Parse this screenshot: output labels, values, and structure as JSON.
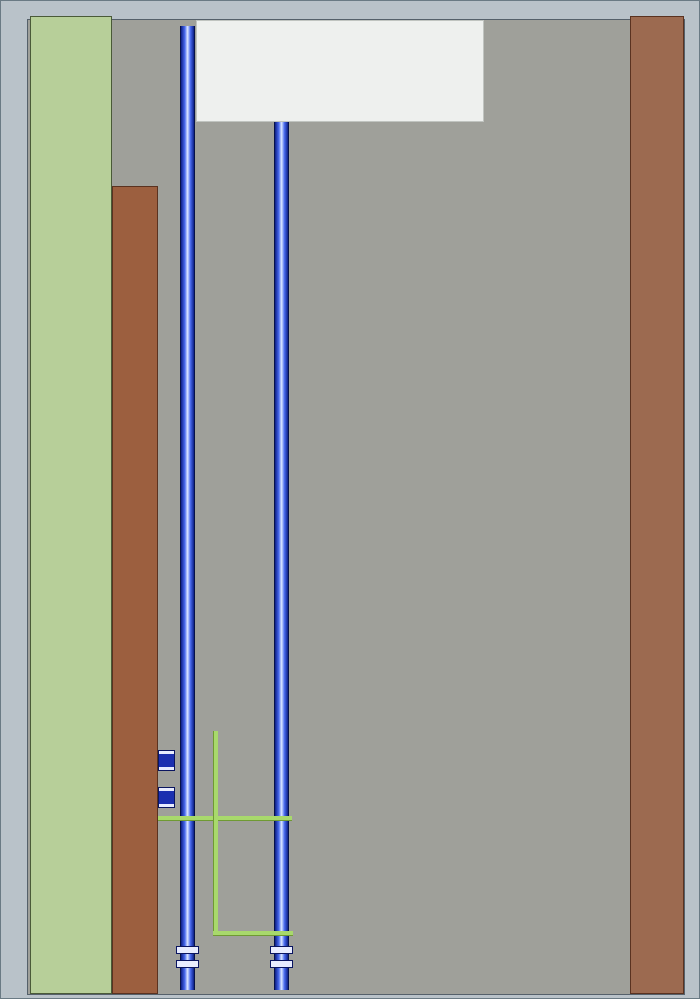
{
  "title": "XX井下中央泵房自动化排水系统主画面",
  "menu": {
    "items": [
      "1#单台画面",
      "2#单台画面",
      "3#单台画面",
      "数据设定画面",
      "生产统计画面",
      "系统报警画面",
      "系统退出键"
    ]
  },
  "mode_panel": {
    "buttons": [
      {
        "label": "控柜模式",
        "state": "active"
      },
      {
        "label": "集控模式",
        "state": "inactive"
      },
      {
        "label": "遥控模式",
        "state": "inactive"
      },
      {
        "label": "紧启模式",
        "state": "inactive"
      },
      {
        "label": "控箱模式",
        "state": "active"
      },
      {
        "label": "1#就地",
        "state": "inactive"
      },
      {
        "label": "2#就地",
        "state": "inactive"
      },
      {
        "label": "3#就地",
        "state": "inactive"
      },
      {
        "label": "参数设置",
        "state": "active"
      },
      {
        "label": "WINCC_SET",
        "state": "inactive"
      },
      {
        "label": "TOUCH_SET",
        "state": "inactive"
      },
      {
        "label": "T触摸屏",
        "state": "active"
      },
      {
        "label": "T自动翻屏",
        "state": "inactive"
      },
      {
        "label": "T手动翻屏",
        "state": "inactive"
      }
    ]
  },
  "footer": {
    "date": "2014-5-11",
    "time": "16:45:39",
    "company": "江苏金宏泰科技股份有限公司"
  },
  "level_buttons": [
    "四米位",
    "三米位",
    "二米位",
    "一米位",
    "0米位"
  ],
  "sump_scale": [
    "+8.00",
    "+7.00",
    "+6.00",
    "+5.00",
    "+4.00",
    "+3.00",
    "+2.00",
    "+1.00",
    "+0.00"
  ],
  "groups": [
    {
      "id": "3#",
      "valve_tag_pairs": [
        [
          "3#闸阀V1",
          "3#排水V1"
        ],
        [
          "3#闸阀V2",
          "3#排水V2"
        ],
        [
          "3#闸阀V3",
          "3#排水V3"
        ]
      ],
      "gauges": [
        {
          "label": "高压表",
          "value": "99.9MPa"
        },
        {
          "label": "真空表",
          "value": "99.9KPa"
        },
        {
          "label": "低压表",
          "value": "99.9MPa"
        }
      ],
      "motor": {
        "current_label": "电流",
        "current_value": "99.9A",
        "temp_label": "温度",
        "temp_value": "99.9℃"
      },
      "pump": {
        "temp_label": "温度",
        "temp_value": "99.9℃"
      },
      "station": {
        "title": "3#液压站",
        "tags": [
          "3#管阀开",
          "3#管阀开",
          "3#管阀开"
        ]
      },
      "display": {
        "label_top": "水仓",
        "label_bottom": "水位",
        "value": "99.99",
        "unit": "米"
      }
    },
    {
      "id": "2#",
      "valve_tag_pairs": [
        [
          "2#闸阀V1",
          "2#排水V1"
        ],
        [
          "2#闸阀V2",
          "2#排水V2"
        ],
        [
          "2#闸阀V3",
          "2#排水V3"
        ]
      ],
      "gauges": [
        {
          "label": "高压表",
          "value": "99.9MPa"
        },
        {
          "label": "真空表",
          "value": "99.9KPa"
        },
        {
          "label": "低压表",
          "value": "99.9MPa"
        }
      ],
      "motor": {
        "current_label": "电流",
        "current_value": "99.9A",
        "temp_label": "温度",
        "temp_value": "99.9℃"
      },
      "pump": {
        "temp_label": "温度",
        "temp_value": "99.9℃"
      },
      "station": {
        "title": "2#液压站",
        "tags": [
          "2#管阀开",
          "2#管阀开",
          "2#管阀开"
        ]
      },
      "display": {
        "label_top": "水仓",
        "label_bottom": "水位",
        "value": "99.99",
        "unit": "米"
      }
    },
    {
      "id": "1#",
      "valve_tag_pairs": [
        [
          "1#闸阀V1",
          "1#排水V1"
        ],
        [
          "1#闸阀V2",
          "1#排水V2"
        ],
        [
          "1#闸阀V3",
          "1#排水V3"
        ]
      ],
      "gauges": [
        {
          "label": "高压表",
          "value": "99.9MPa"
        },
        {
          "label": "真空表",
          "value": "99.9KPa"
        },
        {
          "label": "低压表",
          "value": "99.9MPa"
        }
      ],
      "motor": {
        "current_label": "电流",
        "current_value": "99.9A",
        "temp_label": "温度",
        "temp_value": "99.9℃"
      },
      "pump": {
        "temp_label": "温度",
        "temp_value": "99.9℃"
      },
      "station": {
        "title": "1#液压站",
        "tags": [
          "1#管阀开",
          "1#管阀开",
          "1#管阀开"
        ]
      },
      "display": {
        "label_top": "水仓",
        "label_bottom": "水位",
        "value": "99.99",
        "unit": "米"
      }
    }
  ],
  "colors": {
    "menu_bar": "#b7cf99",
    "menu_button": "#0f74a6",
    "title_bar": "#9c5f3f",
    "footer_bar": "#9c6a50",
    "main_background": "#9fa09a",
    "pipe_blue": "#2a48e0",
    "hydraulic_green": "#a8d96c",
    "suction_pink": "#d8a0d8",
    "water_green": "#4cc63e",
    "alarm_red": "#e03020",
    "active_mode": "#0f9cb4",
    "tag_yellow": "#f2e264",
    "gauge_text_green": "#3ce64a"
  }
}
